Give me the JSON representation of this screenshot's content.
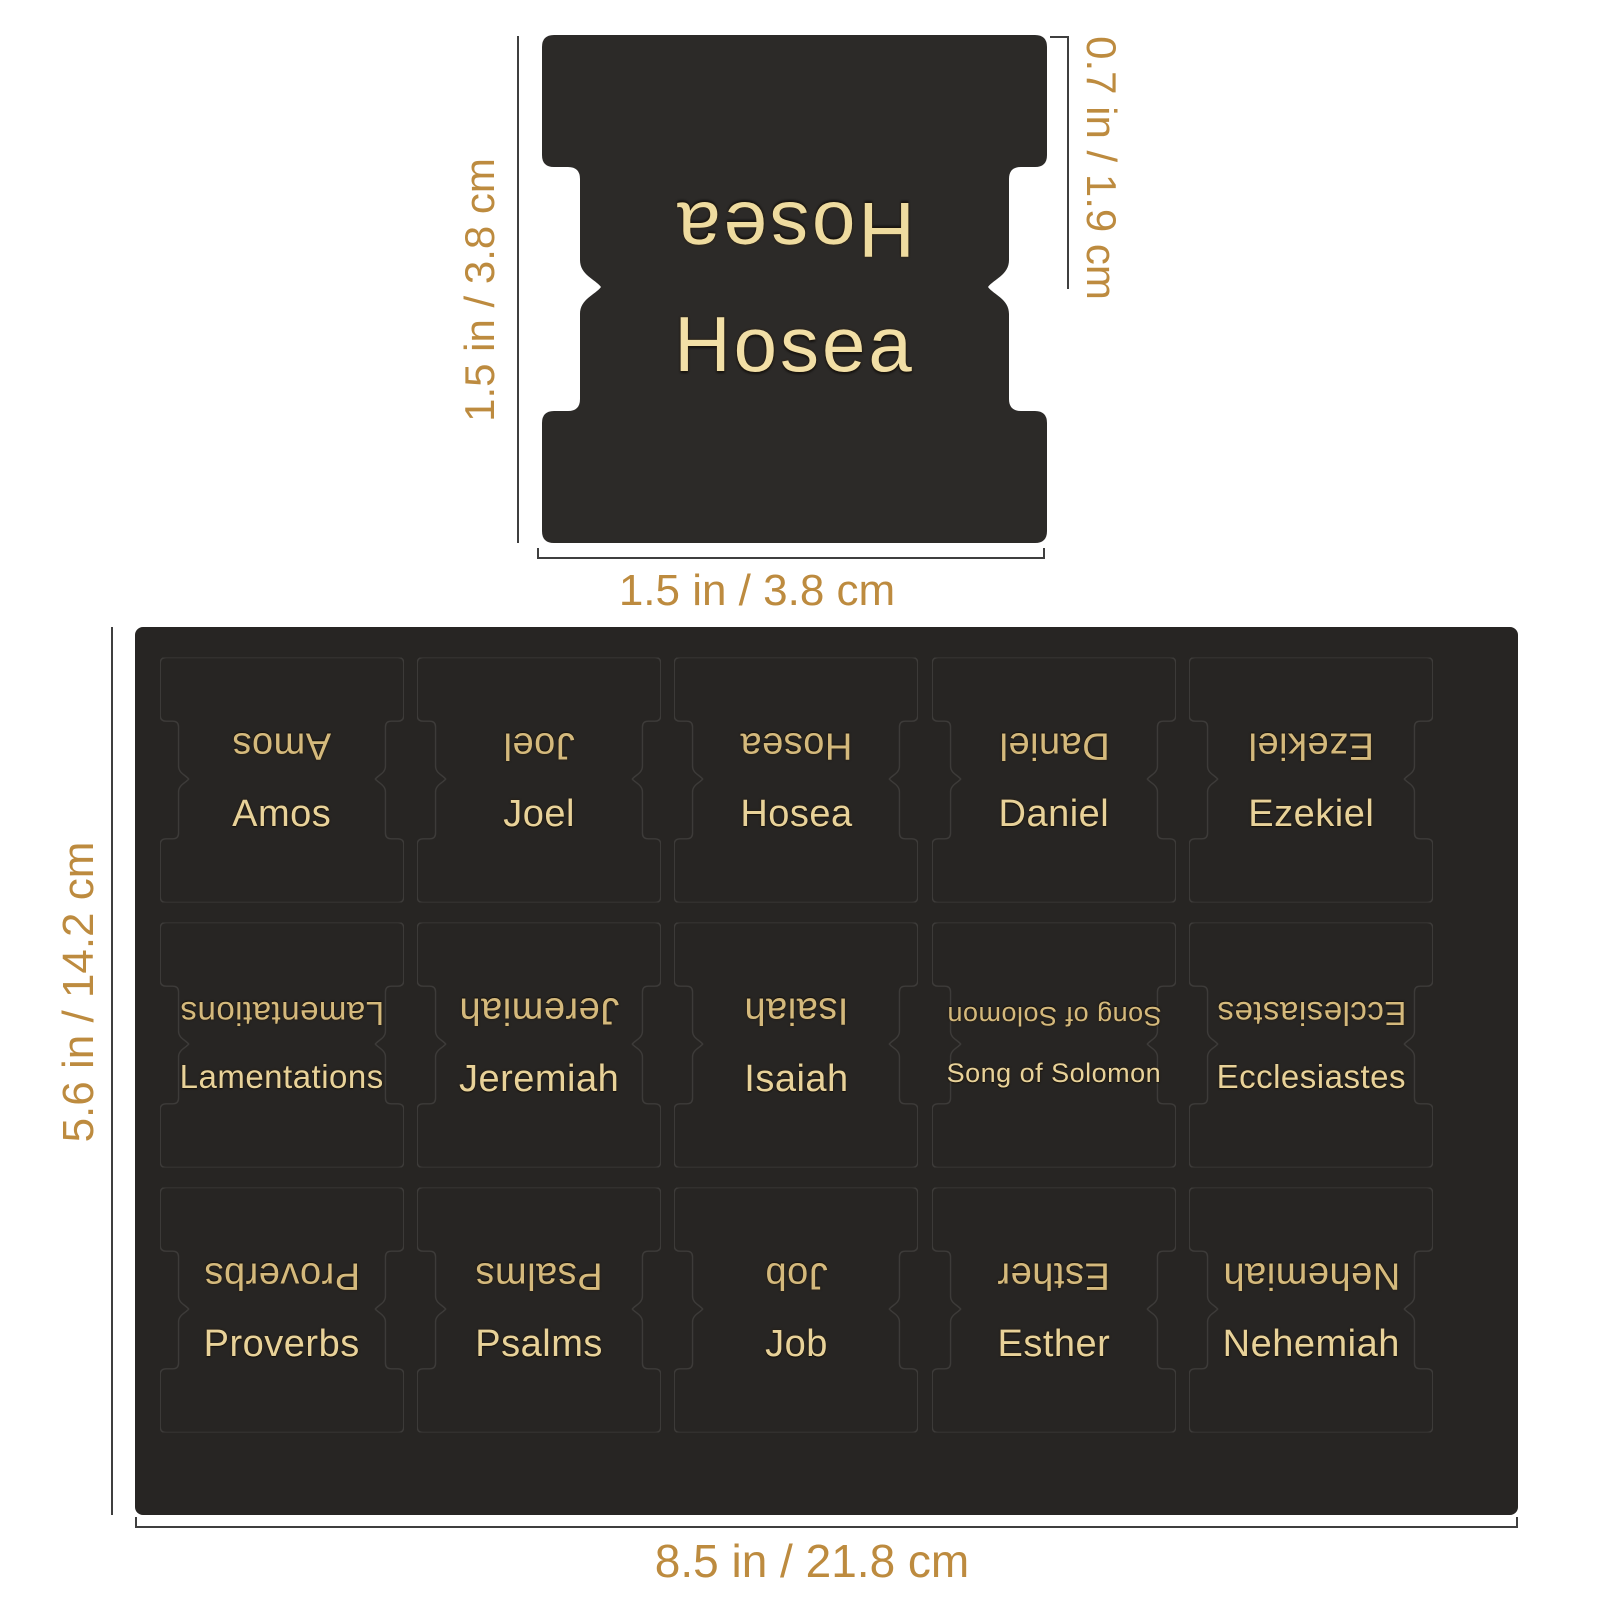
{
  "single_tab": {
    "label": "Hosea",
    "dim_height_label": "1.5 in / 3.8 cm",
    "dim_half_height_label": "0.7 in / 1.9 cm",
    "dim_width_label": "1.5 in / 3.8 cm"
  },
  "sheet": {
    "dim_height_label": "5.6 in / 14.2 cm",
    "dim_width_label": "8.5 in / 21.8 cm",
    "rows": [
      [
        "Amos",
        "Joel",
        "Hosea",
        "Daniel",
        "Ezekiel"
      ],
      [
        "Lamentations",
        "Jeremiah",
        "Isaiah",
        "Song of Solomon",
        "Ecclesiastes"
      ],
      [
        "Proverbs",
        "Psalms",
        "Job",
        "Esther",
        "Nehemiah"
      ]
    ]
  },
  "colors": {
    "background": "#ffffff",
    "tab_black": "#2c2a28",
    "sheet_black": "#272523",
    "gold_tab_text": "#f2dfa6",
    "gold_sheet_text": "#e8d299",
    "gold_sheet_text_mirrored": "#d4b97c",
    "dimension_text": "#bd8b3f",
    "dimension_line": "#3f3f3f"
  }
}
